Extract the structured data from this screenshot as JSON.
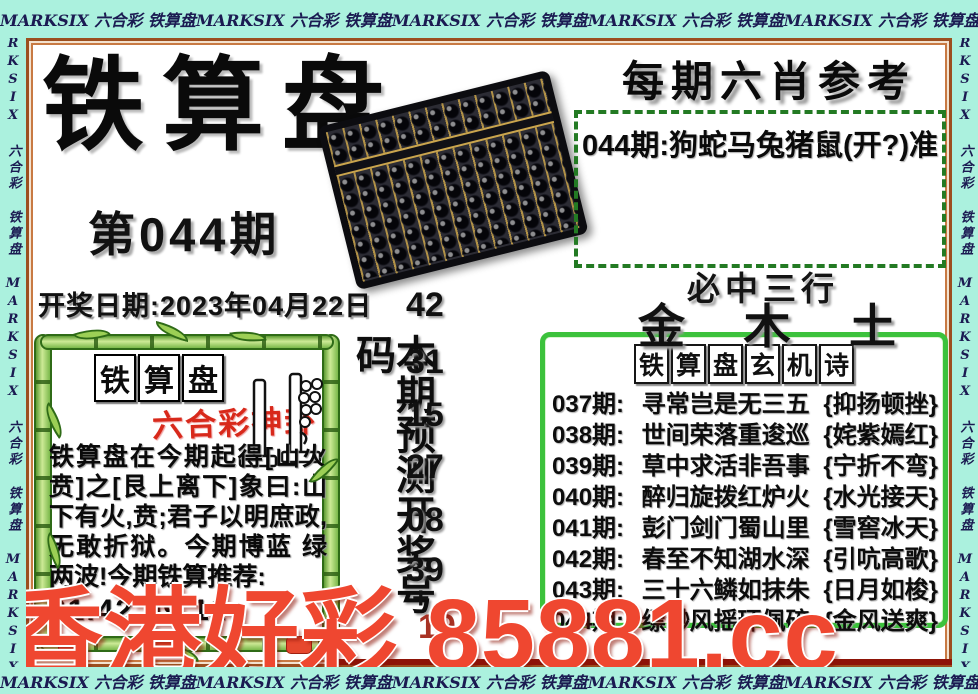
{
  "border": {
    "repeat_text": "MARKSIX 六合彩 铁算盘",
    "repeat_text_vertical": "MARKSIX 六合彩 铁算盘 MARKSIX 六合彩 铁算盘 MARKSIX"
  },
  "header": {
    "title": "铁算盘",
    "issue": "第044期",
    "draw_date": "开奖日期:2023年04月22日"
  },
  "six_xiao": {
    "title": "每期六肖参考",
    "tip": "044期:狗蛇马兔猪鼠(开?)准"
  },
  "three_rows": {
    "title": "必中三行",
    "metals": [
      "金",
      "木",
      "土"
    ]
  },
  "mystery": {
    "title_chars": [
      "铁",
      "算",
      "盘",
      "玄",
      "机",
      "诗"
    ],
    "rows": [
      {
        "issue": "037期:",
        "poem": "寻常岂是无三五",
        "hint": "{抑扬顿挫}"
      },
      {
        "issue": "038期:",
        "poem": "世间荣落重逡巡",
        "hint": "{姹紫嫣红}"
      },
      {
        "issue": "039期:",
        "poem": "草中求活非吾事",
        "hint": "{宁折不弯}"
      },
      {
        "issue": "040期:",
        "poem": "醉归旋拨红炉火",
        "hint": "{水光接天}"
      },
      {
        "issue": "041期:",
        "poem": "彭门剑门蜀山里",
        "hint": "{雪窖冰天}"
      },
      {
        "issue": "042期:",
        "poem": "春至不知湖水深",
        "hint": "{引吭高歌}"
      },
      {
        "issue": "043期:",
        "poem": "三十六鳞如抹朱",
        "hint": "{日月如梭}"
      },
      {
        "issue": "044期:",
        "poem": "缥缈风摇环佩碎",
        "hint": "{金风送爽}"
      }
    ]
  },
  "prediction": {
    "label": "本期预测开奖号码",
    "numbers": [
      "42",
      "31",
      "15",
      "27",
      "08",
      "39"
    ],
    "plus": "+",
    "special": "19"
  },
  "kua_panel": {
    "title_chars": [
      "铁",
      "算",
      "盘"
    ],
    "subtitle": "六合彩神卦",
    "body": "铁算盘在今期起得[山火贲]之[艮上离下]象曰:山下有火,贲;君子以明庶政,无敢折狱。今期博蓝 绿两波!今期铁算推荐:",
    "numbers": "31.42.09.11"
  },
  "watermark": "香港好彩 85881.cc",
  "colors": {
    "strip_bg": "#abf1de",
    "strip_text": "#1b1b52",
    "frame_brown": "#9c4f1f",
    "dash_green": "#237a23",
    "box_green": "#3cc23c",
    "watermark_red": "#ef4730",
    "special_red": "#a83224",
    "subtitle_red": "#d8291b",
    "bamboo_green": "#7ab84a"
  }
}
